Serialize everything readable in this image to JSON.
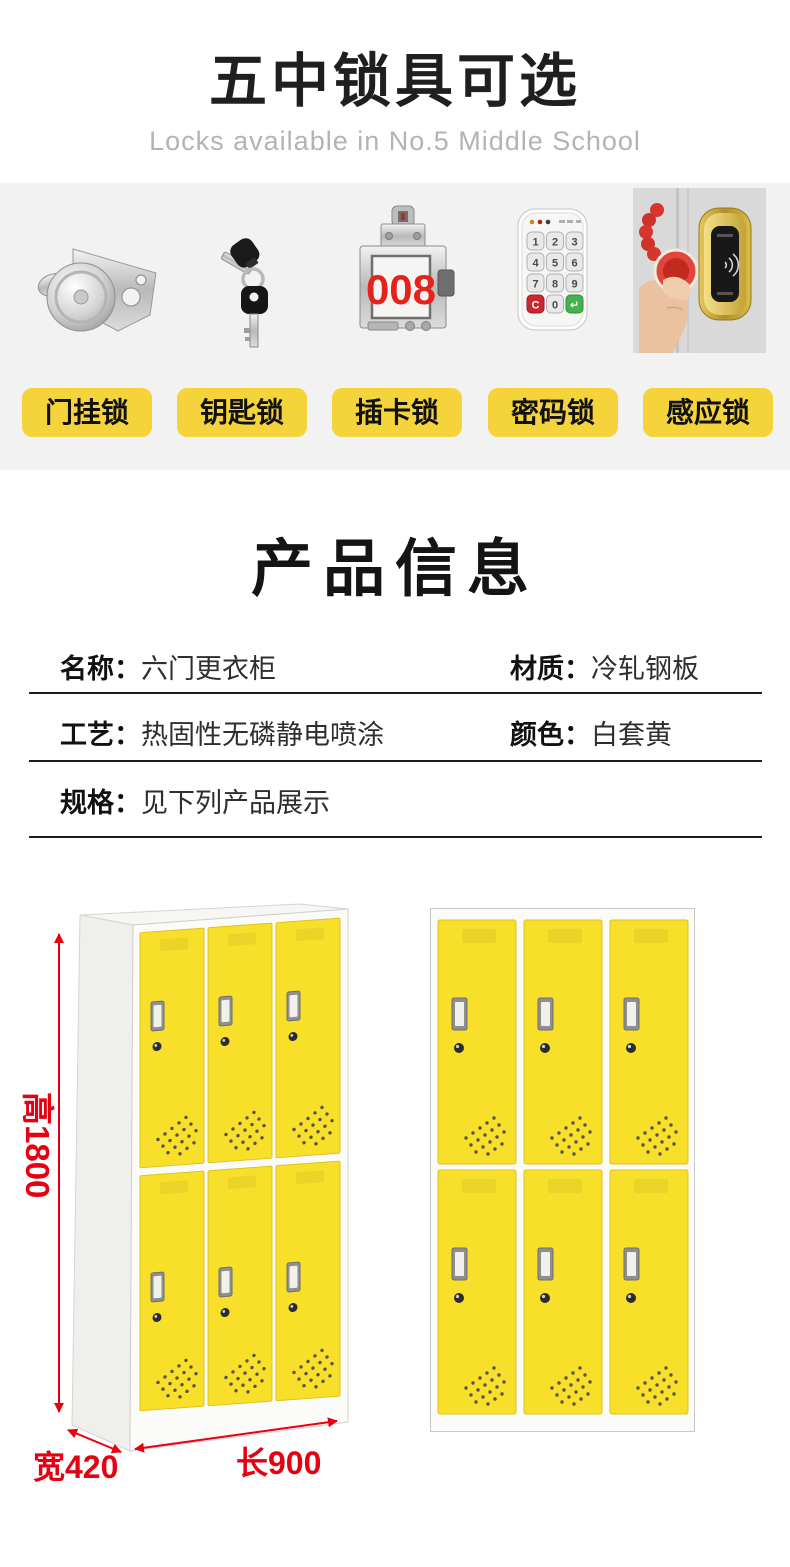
{
  "header": {
    "title": "五中锁具可选",
    "subtitle": "Locks available in No.5 Middle School"
  },
  "locks": {
    "items": [
      {
        "label": "门挂锁",
        "icon": "hasp-lock-icon"
      },
      {
        "label": "钥匙锁",
        "icon": "key-lock-icon"
      },
      {
        "label": "插卡锁",
        "icon": "card-lock-icon",
        "display_number": "008"
      },
      {
        "label": "密码锁",
        "icon": "keypad-lock-icon",
        "keypad_keys": [
          "1",
          "2",
          "3",
          "4",
          "5",
          "6",
          "7",
          "8",
          "9",
          "C",
          "0",
          "↵"
        ]
      },
      {
        "label": "感应锁",
        "icon": "rfid-lock-icon"
      }
    ]
  },
  "product_info": {
    "title": "产品信息",
    "rows": [
      {
        "cells": [
          {
            "label": "名称：",
            "value": "六门更衣柜"
          },
          {
            "label": "材质：",
            "value": "冷轧钢板"
          }
        ]
      },
      {
        "cells": [
          {
            "label": "工艺：",
            "value": "热固性无磷静电喷涂"
          },
          {
            "label": "颜色：",
            "value": "白套黄"
          }
        ]
      },
      {
        "cells": [
          {
            "label": "规格：",
            "value": "见下列产品展示"
          }
        ]
      }
    ]
  },
  "lockers": {
    "doors_per_locker": 6,
    "grid": "3x2",
    "dimensions": {
      "height": "高1800",
      "width": "宽420",
      "length": "长900"
    }
  },
  "colors": {
    "band_gray": "#f2f2f2",
    "pill_yellow": "#f5d33a",
    "door_yellow": "#f8e02a",
    "dimension_red": "#e60012",
    "digits_red": "#e5231c"
  }
}
